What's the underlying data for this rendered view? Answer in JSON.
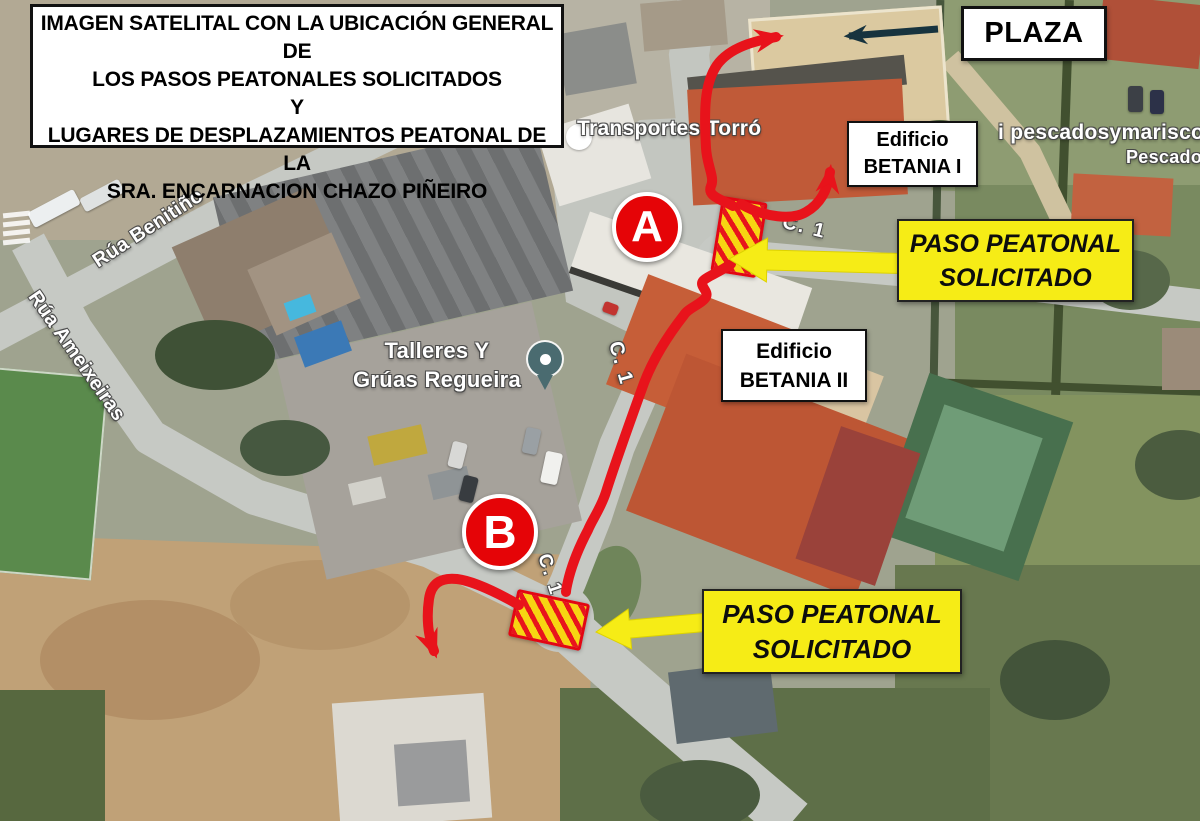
{
  "header": {
    "box_lines": [
      "IMAGEN SATELITAL CON LA UBICACIÓN GENERAL DE",
      "LOS PASOS PEATONALES SOLICITADOS",
      "Y",
      "LUGARES DE DESPLAZAMIENTOS PEATONAL  DE LA",
      "SRA.  ENCARNACION CHAZO PIÑEIRO"
    ]
  },
  "callouts": {
    "plaza": "PLAZA",
    "betania1": {
      "line1": "Edificio",
      "line2": "BETANIA I"
    },
    "betania2": {
      "line1": "Edificio",
      "line2": "BETANIA II"
    },
    "paso_a": {
      "line1": "PASO PEATONAL",
      "line2": "SOLICITADO"
    },
    "paso_b": {
      "line1": "PASO PEATONAL",
      "line2": "SOLICITADO"
    },
    "marker_a": "A",
    "marker_b": "B"
  },
  "map_labels": {
    "transportes": "Transportes Torró",
    "talleres": {
      "line1": "Talleres Y",
      "line2": "Grúas Regueira"
    },
    "rua_benitino": "Rúa Benitiño",
    "rua_ameixeiras": "Rúa Ameixeiras",
    "c1": "C. 1",
    "pescados": "i pescadosymarisco",
    "pescado_partial": "Pescado"
  },
  "colors": {
    "annotation_red": "#e8131b",
    "crossing_yellow": "#f7d512",
    "highlight_yellow": "#f6ec16",
    "callout_bg": "#ffffff",
    "callout_border": "#111111",
    "dark_arrow": "#17333e",
    "pin_teal": "#4a6b70"
  }
}
